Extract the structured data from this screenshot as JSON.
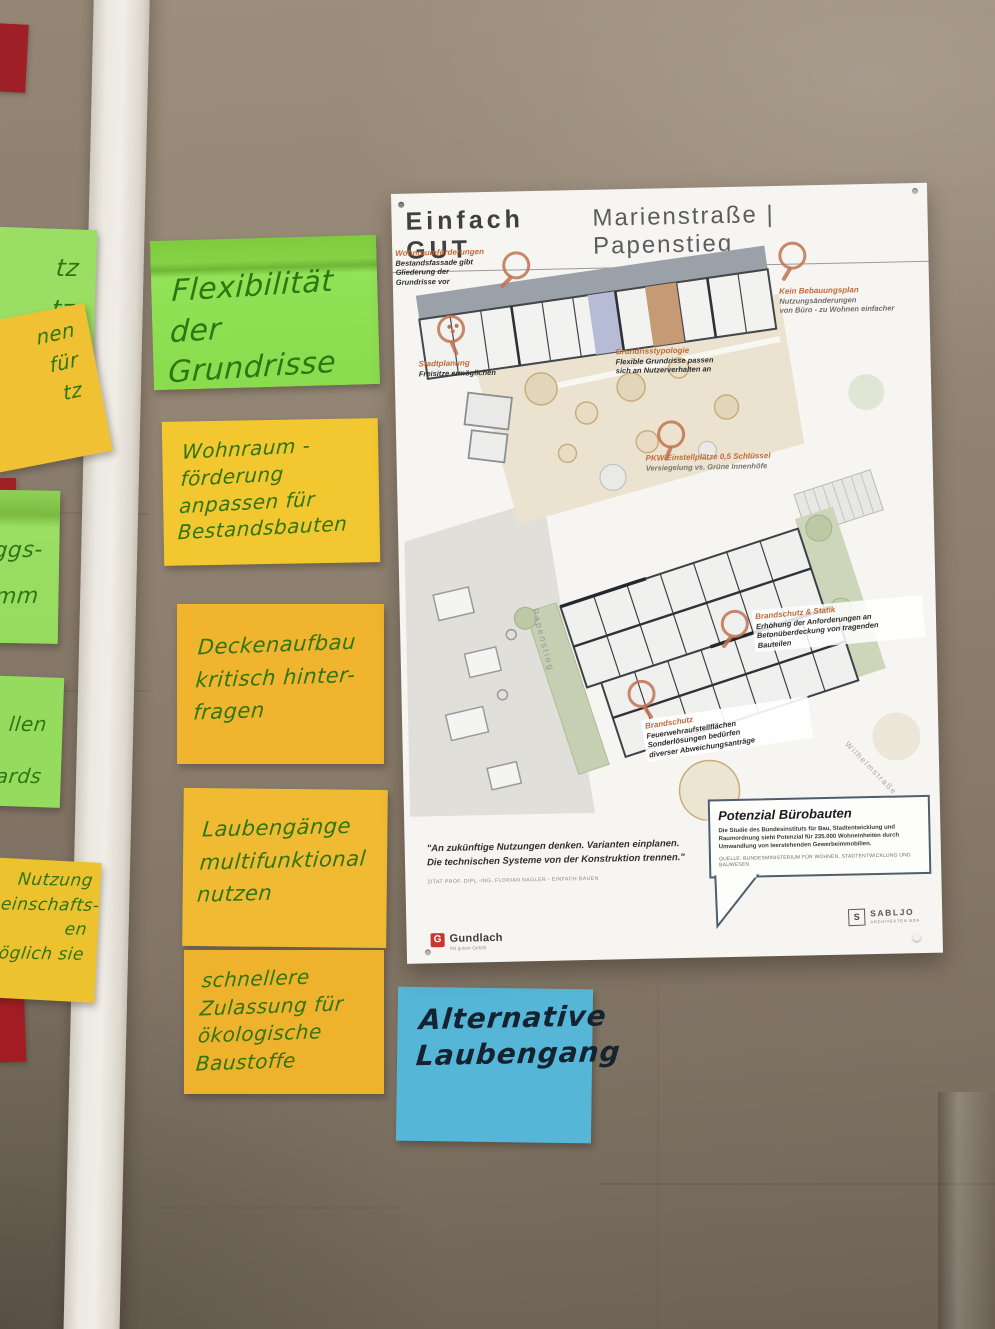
{
  "colors": {
    "cardboard": "#8a7c6c",
    "divider_strip": "#ece9e2",
    "poster_paper": "#f6f5f2",
    "annotation_orange": "#c06a38",
    "magnifier_orange": "#bf7350",
    "plan_blue_unit": "#b6bcd6",
    "plan_tan_unit": "#c69a72",
    "note_green": "#8bdb4e",
    "note_yellow": "#f2c72f",
    "note_orange": "#f0b42e",
    "note_blue": "#56b6d8",
    "note_red": "#a02128",
    "ink_green": "#2e7612",
    "ink_black": "#14232f",
    "gundlach_red": "#c8372d"
  },
  "poster": {
    "title_left": "Einfach GUT",
    "title_right": "Marienstraße | Papenstieg",
    "annotations": [
      {
        "heading": "Wohnraumförderungen",
        "body": "Bestandsfassade gibt\nGliederung der\nGrundrisse vor"
      },
      {
        "heading": "Stadtplanung",
        "body": "Freisitze ermöglichen"
      },
      {
        "heading": "Kein Bebauungsplan",
        "body": "Nutzungsänderungen\nvon Büro - zu Wohnen einfacher"
      },
      {
        "heading": "Grundrisstypologie",
        "body": "Flexible Grundrisse passen\nsich an Nutzerverhalten an"
      },
      {
        "heading": "PKW Einstellplätze 0,5 Schlüssel",
        "body": "Versiegelung vs. Grüne Innenhöfe"
      },
      {
        "heading": "Brandschutz & Statik",
        "body": "Erhöhung der Anforderungen an\nBetonüberdeckung von tragenden\nBauteilen"
      },
      {
        "heading": "Brandschutz",
        "body": "Feuerwehraufstellflächen\nSonderlösungen bedürfen\ndiverser Abweichungsanträge"
      }
    ],
    "street_labels": [
      "Papenstieg",
      "Wilhelmstraße"
    ],
    "quote_text": "\"An zukünftige Nutzungen denken. Varianten einplanen.\nDie technischen Systeme von der Konstruktion trennen.\"",
    "quote_source": "ZITAT PROF. DIPL.-ING. FLORIAN NAGLER - EINFACH BAUEN",
    "info_box": {
      "title": "Potenzial Bürobauten",
      "body": "Die Studie des Bundesinstituts für Bau, Stadtentwicklung und Raumordnung sieht Potenzial für 235.000 Wohneinheiten durch Umwandlung von leerstehenden Gewerbeimmobilien.",
      "source": "QUELLE: BUNDESMINISTERIUM FÜR WOHNEN, STADTENTWICKLUNG UND BAUWESEN"
    },
    "logo_gundlach": {
      "mark": "G",
      "name": "Gundlach",
      "tagline": "Mit gutem Gefühl"
    },
    "logo_sabljo": {
      "mark": "S",
      "name": "SABLJO",
      "sub": "ARCHITEKTEN BDA"
    }
  },
  "sticky_notes": [
    {
      "color": "green",
      "text": "Flexibilität\nder Grundrisse"
    },
    {
      "color": "yellow",
      "text": "Wohnraum -\nförderung\nanpassen für\nBestandsbauten"
    },
    {
      "color": "orange",
      "text": "Deckenaufbau\nkritisch hinter-\nfragen"
    },
    {
      "color": "orange",
      "text": "Laubengänge\nmultifunktional\nnutzen"
    },
    {
      "color": "orange",
      "text": "schnellere\nZulassung für\nökologische\nBaustoffe"
    },
    {
      "color": "blue",
      "text": "Alternative\nLaubengang"
    }
  ],
  "edge_fragments": [
    {
      "color": "green",
      "text": "tz\ntz"
    },
    {
      "color": "yellow",
      "text": "nen\nfür\ntz"
    },
    {
      "color": "green",
      "text": "ggs-\nmm"
    },
    {
      "color": "green",
      "text": "llen\ndards"
    },
    {
      "color": "orange",
      "text": "Nutzung\nmeinschafts-\nen\nöglich sie"
    }
  ]
}
